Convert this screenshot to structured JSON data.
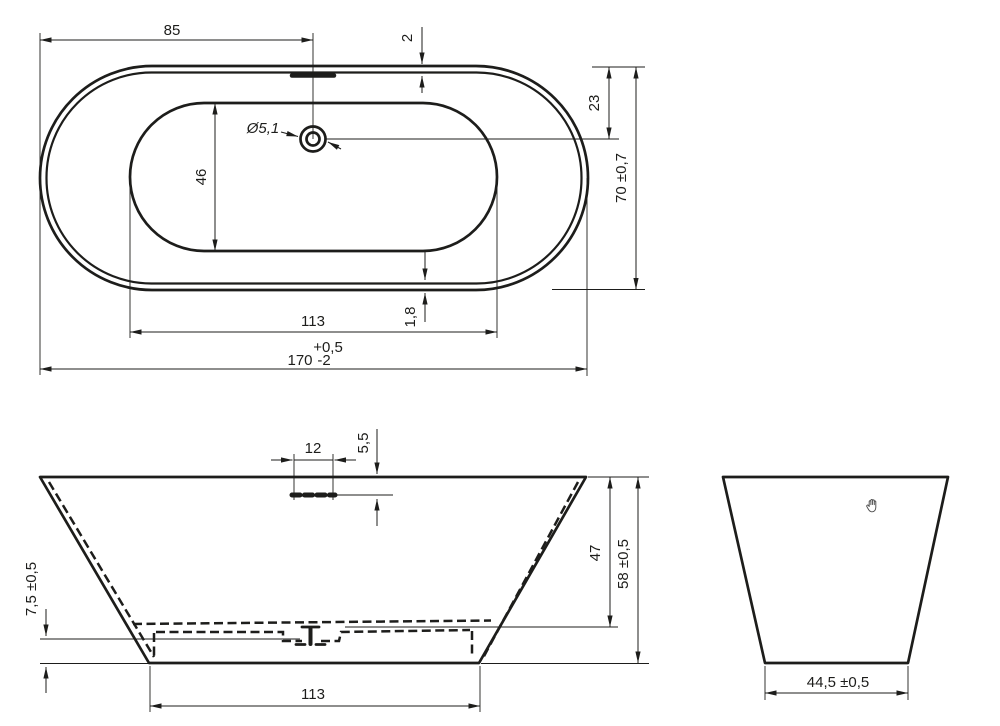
{
  "colors": {
    "background": "#ffffff",
    "line": "#1d1d1b"
  },
  "views": {
    "top": {
      "dims": {
        "left_to_overflow": "85",
        "rim_thickness_top": "2",
        "top_to_drain": "23",
        "overall_width": "70 ±0,7",
        "drain_diameter": "Ø5,1",
        "basin_width": "46",
        "basin_length": "113",
        "rim_thickness_bottom": "1,8",
        "overall_length": "170",
        "overall_length_tol_upper": "+0,5",
        "overall_length_tol_lower": "-2"
      }
    },
    "front": {
      "dims": {
        "overflow_width": "12",
        "overflow_depth": "5,5",
        "floor_recess_height": "7,5 ±0,5",
        "inner_depth": "47",
        "overall_height": "58 ±0,5",
        "base_length": "113"
      }
    },
    "side": {
      "dims": {
        "base_width": "44,5 ±0,5"
      },
      "hand_icon": "grab-hand-cursor"
    }
  }
}
